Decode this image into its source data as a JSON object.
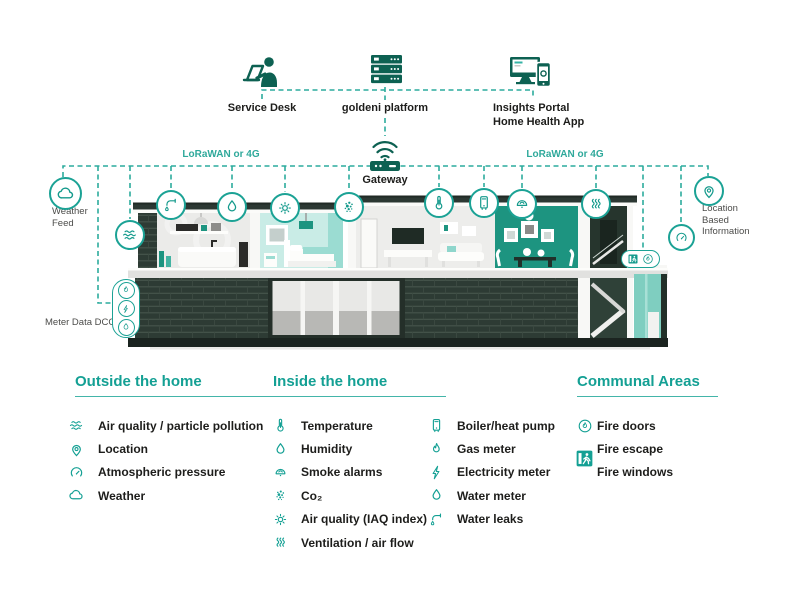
{
  "colors": {
    "accent_teal": "#14a094",
    "dashed_teal": "#2cab9d",
    "icon_dark": "#0d6152",
    "text_dark": "#1d1d1b",
    "dining_teal": "#1d9480",
    "brick_dark": "#2d3b34",
    "tower_glass": "#7fcec0"
  },
  "top": {
    "service_desk_label": "Service Desk",
    "platform_label": "goldeni platform",
    "insights_label_line1": "Insights Portal",
    "insights_label_line2": "Home Health App",
    "gateway_label": "Gateway",
    "lorawan_left": "LoRaWAN or 4G",
    "lorawan_right": "LoRaWAN or 4G",
    "icons": {
      "service_desk": "person-at-laptop",
      "platform": "server-stack",
      "insights": "monitor-and-phone",
      "gateway": "wifi-router"
    }
  },
  "annotations": {
    "weather_line1": "Weather",
    "weather_line2": "Feed",
    "meter_label": "Meter Data DCC",
    "location_line1": "Location",
    "location_line2": "Based",
    "location_line3": "Information"
  },
  "sensors": {
    "weather": {
      "symbol": "#sym-cloud"
    },
    "water_leaks": {
      "symbol": "#sym-leak"
    },
    "humidity": {
      "symbol": "#sym-drop"
    },
    "air_quality": {
      "symbol": "#sym-waves"
    },
    "iaq": {
      "symbol": "#sym-sun"
    },
    "co2": {
      "symbol": "#sym-co2"
    },
    "temperature": {
      "symbol": "#sym-thermo"
    },
    "boiler": {
      "symbol": "#sym-boiler"
    },
    "smoke": {
      "symbol": "#sym-smoke"
    },
    "ventilation": {
      "symbol": "#sym-vent"
    },
    "pressure": {
      "symbol": "#sym-gauge"
    },
    "location": {
      "symbol": "#sym-pin"
    }
  },
  "meter": {
    "icons": [
      {
        "symbol": "#sym-flame"
      },
      {
        "symbol": "#sym-bolt"
      },
      {
        "symbol": "#sym-drop"
      }
    ]
  },
  "fire": {
    "icons": [
      {
        "symbol": "#sym-exitman"
      },
      {
        "symbol": "#sym-flamecircle"
      }
    ]
  },
  "legend": {
    "outside": {
      "title": "Outside the home",
      "items": [
        {
          "symbol": "#sym-waves",
          "label": "Air quality / particle pollution"
        },
        {
          "symbol": "#sym-pin",
          "label": "Location"
        },
        {
          "symbol": "#sym-gauge",
          "label": "Atmospheric pressure"
        },
        {
          "symbol": "#sym-cloud",
          "label": "Weather"
        }
      ]
    },
    "inside": {
      "title": "Inside the home",
      "col1": [
        {
          "symbol": "#sym-thermo",
          "label": "Temperature"
        },
        {
          "symbol": "#sym-drop",
          "label": "Humidity"
        },
        {
          "symbol": "#sym-smoke",
          "label": "Smoke alarms"
        },
        {
          "symbol": "#sym-co2",
          "label": "Co₂"
        },
        {
          "symbol": "#sym-sun",
          "label": "Air quality (IAQ index)"
        },
        {
          "symbol": "#sym-vent",
          "label": "Ventilation / air flow"
        }
      ],
      "col2": [
        {
          "symbol": "#sym-boiler",
          "label": "Boiler/heat pump"
        },
        {
          "symbol": "#sym-flame",
          "label": "Gas meter"
        },
        {
          "symbol": "#sym-bolt",
          "label": "Electricity meter"
        },
        {
          "symbol": "#sym-drop",
          "label": "Water meter"
        },
        {
          "symbol": "#sym-leak",
          "label": "Water leaks"
        }
      ]
    },
    "communal": {
      "title": "Communal Areas",
      "items": [
        {
          "symbol": "#sym-flamecircle",
          "label": "Fire doors"
        },
        {
          "symbol": "#sym-exitman",
          "label": "Fire escape"
        },
        {
          "symbol": "",
          "label": "Fire windows"
        }
      ]
    }
  }
}
